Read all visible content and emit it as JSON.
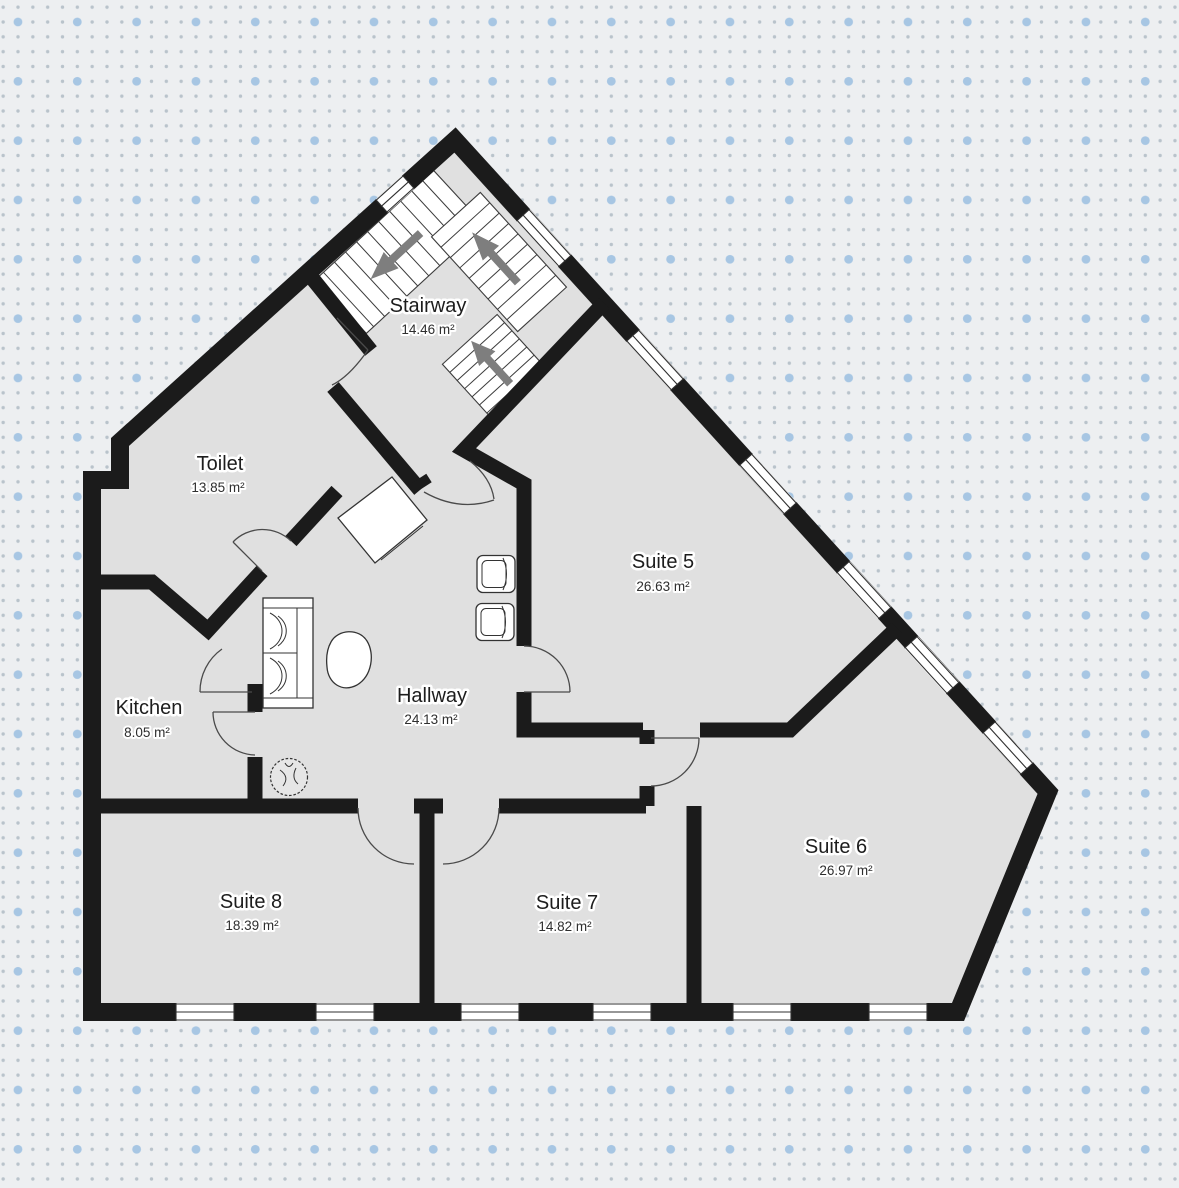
{
  "app": {
    "view": "floor-plan-editor-canvas",
    "units": "m²",
    "theme": {
      "background_color": "#edeff1",
      "dot_small_color": "#b9c3cb",
      "dot_big_color": "#a7c6e3",
      "floor_color": "#e0e0e0",
      "wall_color": "#1b1b1b",
      "stair_arrow_color": "#7e7e7e",
      "label_color": "#1d1d1d"
    }
  },
  "rooms": [
    {
      "id": "stairway",
      "name": "Stairway",
      "area": "14.46 m²"
    },
    {
      "id": "toilet",
      "name": "Toilet",
      "area": "13.85 m²"
    },
    {
      "id": "suite5",
      "name": "Suite 5",
      "area": "26.63 m²"
    },
    {
      "id": "kitchen",
      "name": "Kitchen",
      "area": "8.05 m²"
    },
    {
      "id": "hallway",
      "name": "Hallway",
      "area": "24.13 m²"
    },
    {
      "id": "suite6",
      "name": "Suite 6",
      "area": "26.97 m²"
    },
    {
      "id": "suite8",
      "name": "Suite 8",
      "area": "18.39 m²"
    },
    {
      "id": "suite7",
      "name": "Suite 7",
      "area": "14.82 m²"
    }
  ],
  "elements": {
    "stair_flights": 3,
    "stair_arrow_icon": "stair-direction-arrow",
    "windows_top_diagonal": 6,
    "windows_bottom_wall": 6,
    "windows_upper_left_diagonal": 1,
    "doors": 9,
    "furniture": [
      "sofa",
      "armchair",
      "armchair",
      "side-table-rotated",
      "coffee-table-blob",
      "plant"
    ]
  }
}
